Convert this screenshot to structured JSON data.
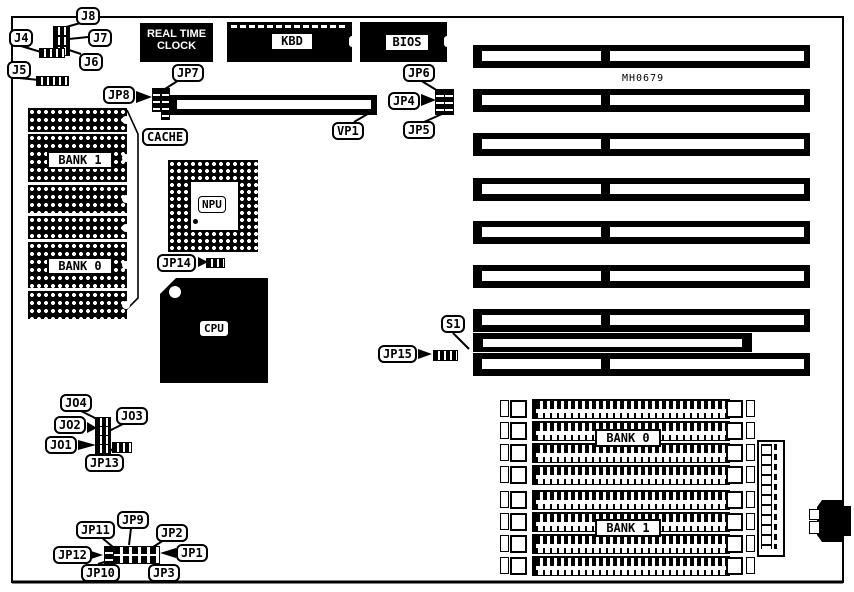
{
  "board": {
    "model": "MH0679"
  },
  "chips": {
    "rtc_line1": "REAL TIME",
    "rtc_line2": "CLOCK",
    "kbd": "KBD",
    "bios": "BIOS",
    "npu": "NPU",
    "cpu": "CPU"
  },
  "memory": {
    "dip_bank1": "BANK 1",
    "dip_bank0": "BANK 0",
    "simm_bank0": "BANK 0",
    "simm_bank1": "BANK 1"
  },
  "callouts": {
    "j8": "J8",
    "j7": "J7",
    "j6": "J6",
    "j4": "J4",
    "j5": "J5",
    "jp7": "JP7",
    "jp8": "JP8",
    "jp6": "JP6",
    "jp4": "JP4",
    "jp5": "JP5",
    "vp1": "VP1",
    "cache": "CACHE",
    "jp14": "JP14",
    "s1": "S1",
    "jp15": "JP15",
    "jo4": "JO4",
    "jo3": "JO3",
    "jo2": "JO2",
    "jo1": "JO1",
    "jp13": "JP13",
    "jp11": "JP11",
    "jp9": "JP9",
    "jp2": "JP2",
    "jp12": "JP12",
    "jp1": "JP1",
    "jp10": "JP10",
    "jp3": "JP3"
  },
  "colors": {
    "ink": "#000000",
    "paper": "#ffffff"
  }
}
